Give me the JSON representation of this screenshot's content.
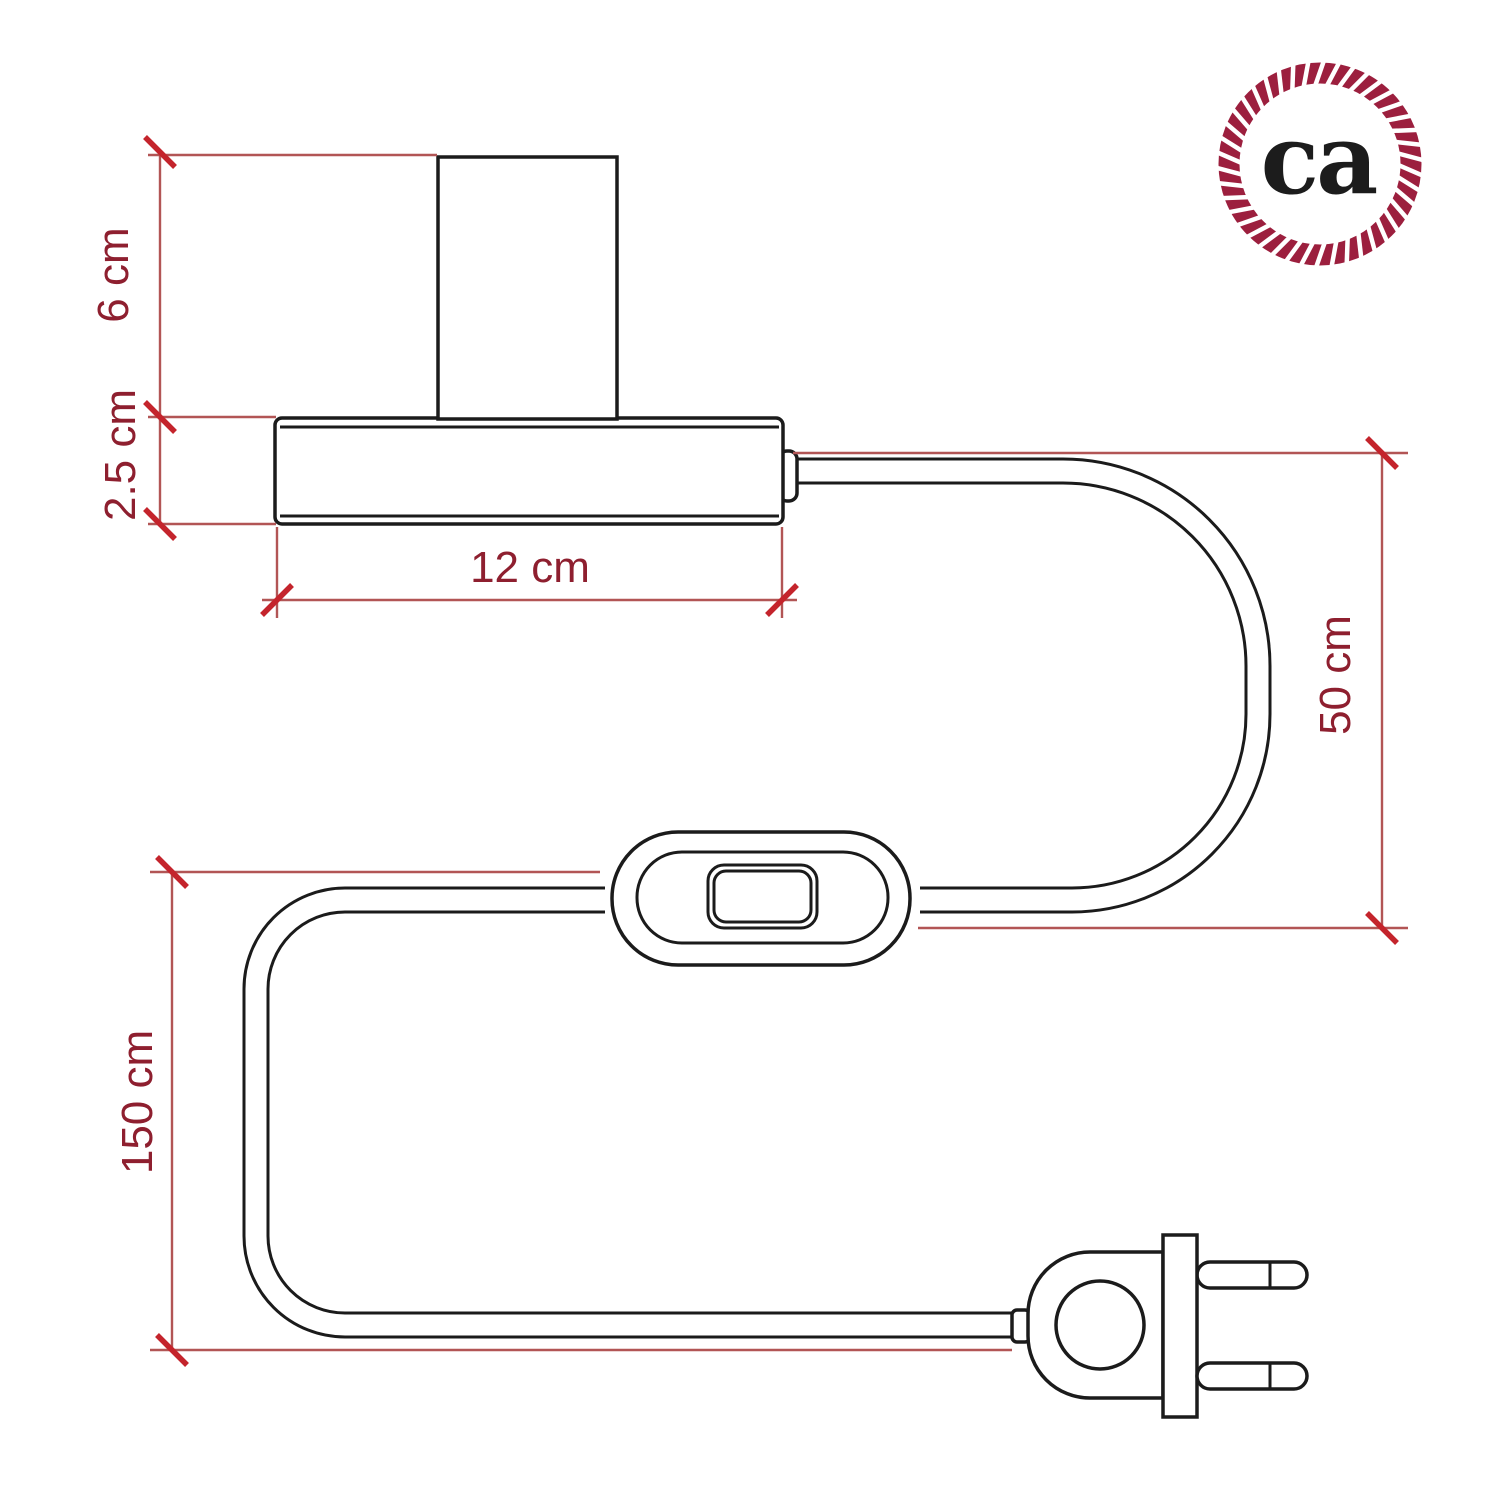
{
  "dimensions": {
    "socket_height": "6 cm",
    "base_height": "2.5 cm",
    "base_width": "12 cm",
    "lamp_to_switch_cable": "50 cm",
    "total_cable_length": "150 cm"
  },
  "logo": {
    "text": "ca"
  },
  "colors": {
    "drawing_line": "#1b1b1b",
    "dimension_line": "#b25555",
    "tick": "#c4242c",
    "dimension_label": "#8e1f2f",
    "brand": "#9c1f3e"
  }
}
